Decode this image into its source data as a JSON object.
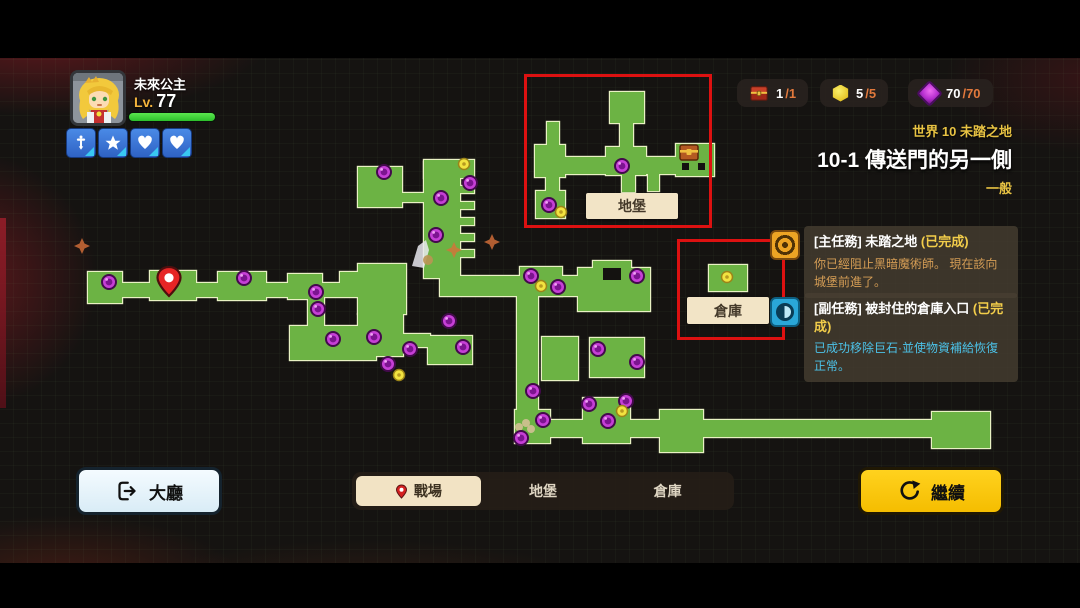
{
  "hud": {
    "player": {
      "name": "未來公主",
      "level_prefix": "Lv.",
      "level": "77",
      "hp_percent": 100
    },
    "badges": [
      {
        "icon": "sword-icon"
      },
      {
        "icon": "star-icon"
      },
      {
        "icon": "heart-icon"
      },
      {
        "icon": "heart-icon"
      }
    ],
    "resources": [
      {
        "icon": "chest-icon",
        "value": "1",
        "max": "/1"
      },
      {
        "icon": "hex-gem-icon",
        "value": "5",
        "max": "/5"
      },
      {
        "icon": "purple-gem-icon",
        "value": "70",
        "max": "/70"
      }
    ],
    "stage": {
      "world": "世界 10 未踏之地",
      "title": "10-1 傳送門的另一側",
      "difficulty": "一般"
    }
  },
  "quests": [
    {
      "kind": "main",
      "title": "[主任務] 未踏之地",
      "status": "(已完成)",
      "desc": "你已經阻止黑暗魔術師。 現在該向城堡前進了。"
    },
    {
      "kind": "side",
      "title": "[副任務] 被封住的倉庫入口",
      "status": "(已完成)",
      "desc": "已成功移除巨石·並使物資補給恢復正常。"
    }
  ],
  "footer": {
    "lobby_label": "大廳",
    "tabs": [
      {
        "label": "戰場",
        "active": true
      },
      {
        "label": "地堡",
        "active": false
      },
      {
        "label": "倉庫",
        "active": false
      }
    ],
    "continue_label": "繼續"
  },
  "map": {
    "labels": {
      "bunker": "地堡",
      "warehouse": "倉庫"
    },
    "colors": {
      "room": "#6cb344",
      "outline": "#e9f2c4",
      "bg": "#141210",
      "orb": "#c63fd6",
      "orb_core": "#7c1490",
      "dot": "#f2e340",
      "pin": "#e62525",
      "annotation": "#dd1111"
    },
    "main_rooms": [
      [
        88,
        272,
        34,
        31
      ],
      [
        120,
        283,
        252,
        14
      ],
      [
        150,
        271,
        46,
        29
      ],
      [
        218,
        272,
        48,
        28
      ],
      [
        288,
        274,
        34,
        25
      ],
      [
        340,
        272,
        30,
        13
      ],
      [
        358,
        264,
        48,
        50
      ],
      [
        358,
        314,
        45,
        42
      ],
      [
        400,
        334,
        30,
        13
      ],
      [
        428,
        336,
        44,
        28
      ],
      [
        358,
        167,
        44,
        40
      ],
      [
        398,
        193,
        28,
        9
      ],
      [
        424,
        160,
        50,
        18
      ],
      [
        424,
        162,
        36,
        116
      ],
      [
        458,
        186,
        16,
        7
      ],
      [
        458,
        202,
        16,
        7
      ],
      [
        458,
        218,
        16,
        7
      ],
      [
        458,
        234,
        16,
        7
      ],
      [
        458,
        250,
        16,
        7
      ],
      [
        308,
        297,
        16,
        31
      ],
      [
        290,
        326,
        86,
        34
      ],
      [
        440,
        276,
        144,
        20
      ],
      [
        520,
        267,
        42,
        29
      ],
      [
        578,
        268,
        72,
        43
      ],
      [
        593,
        261,
        38,
        26
      ],
      [
        517,
        296,
        21,
        118
      ],
      [
        542,
        337,
        36,
        43
      ],
      [
        590,
        338,
        54,
        39
      ],
      [
        515,
        410,
        35,
        33
      ],
      [
        550,
        420,
        33,
        17
      ],
      [
        583,
        398,
        47,
        45
      ],
      [
        630,
        420,
        30,
        17
      ],
      [
        660,
        410,
        43,
        42
      ],
      [
        703,
        420,
        230,
        17
      ],
      [
        932,
        412,
        58,
        36
      ]
    ],
    "bunker_rooms": [
      [
        610,
        92,
        34,
        31
      ],
      [
        620,
        122,
        13,
        36
      ],
      [
        537,
        157,
        176,
        17
      ],
      [
        535,
        145,
        30,
        32
      ],
      [
        547,
        122,
        12,
        25
      ],
      [
        546,
        174,
        13,
        19
      ],
      [
        536,
        191,
        29,
        27
      ],
      [
        606,
        147,
        40,
        28
      ],
      [
        622,
        175,
        13,
        17
      ],
      [
        648,
        174,
        11,
        17
      ],
      [
        676,
        144,
        38,
        32
      ]
    ],
    "warehouse_rooms": [
      [
        709,
        265,
        38,
        26
      ]
    ],
    "cuts": [
      [
        603,
        268,
        18,
        12
      ],
      [
        682,
        163,
        7,
        7
      ],
      [
        698,
        163,
        7,
        7
      ]
    ],
    "orbs": [
      [
        109,
        282
      ],
      [
        244,
        278
      ],
      [
        316,
        292
      ],
      [
        318,
        309
      ],
      [
        333,
        339
      ],
      [
        374,
        337
      ],
      [
        384,
        172
      ],
      [
        470,
        183
      ],
      [
        441,
        198
      ],
      [
        436,
        235
      ],
      [
        531,
        276
      ],
      [
        558,
        287
      ],
      [
        637,
        276
      ],
      [
        449,
        321
      ],
      [
        463,
        347
      ],
      [
        410,
        349
      ],
      [
        388,
        364
      ],
      [
        598,
        349
      ],
      [
        637,
        362
      ],
      [
        533,
        391
      ],
      [
        543,
        420
      ],
      [
        521,
        438
      ],
      [
        589,
        404
      ],
      [
        608,
        421
      ],
      [
        626,
        401
      ],
      [
        622,
        166
      ],
      [
        549,
        205
      ]
    ],
    "dots": [
      [
        464,
        164
      ],
      [
        541,
        286
      ],
      [
        399,
        375
      ],
      [
        622,
        411
      ],
      [
        561,
        212
      ],
      [
        727,
        277
      ]
    ],
    "pin": [
      169,
      281
    ],
    "chest": [
      689,
      153
    ],
    "sprites": {
      "angel": [
        412,
        240
      ],
      "debris": [
        519,
        423
      ],
      "sparkles": [
        [
          492,
          242
        ],
        [
          454,
          250
        ],
        [
          82,
          246
        ]
      ]
    },
    "annotations": {
      "bunker_rect": [
        524,
        74,
        188,
        154
      ],
      "warehouse_rect": [
        677,
        239,
        108,
        101
      ]
    },
    "label_boxes": {
      "bunker": [
        586,
        193,
        92,
        26
      ],
      "warehouse": [
        687,
        297,
        82,
        27
      ]
    }
  }
}
